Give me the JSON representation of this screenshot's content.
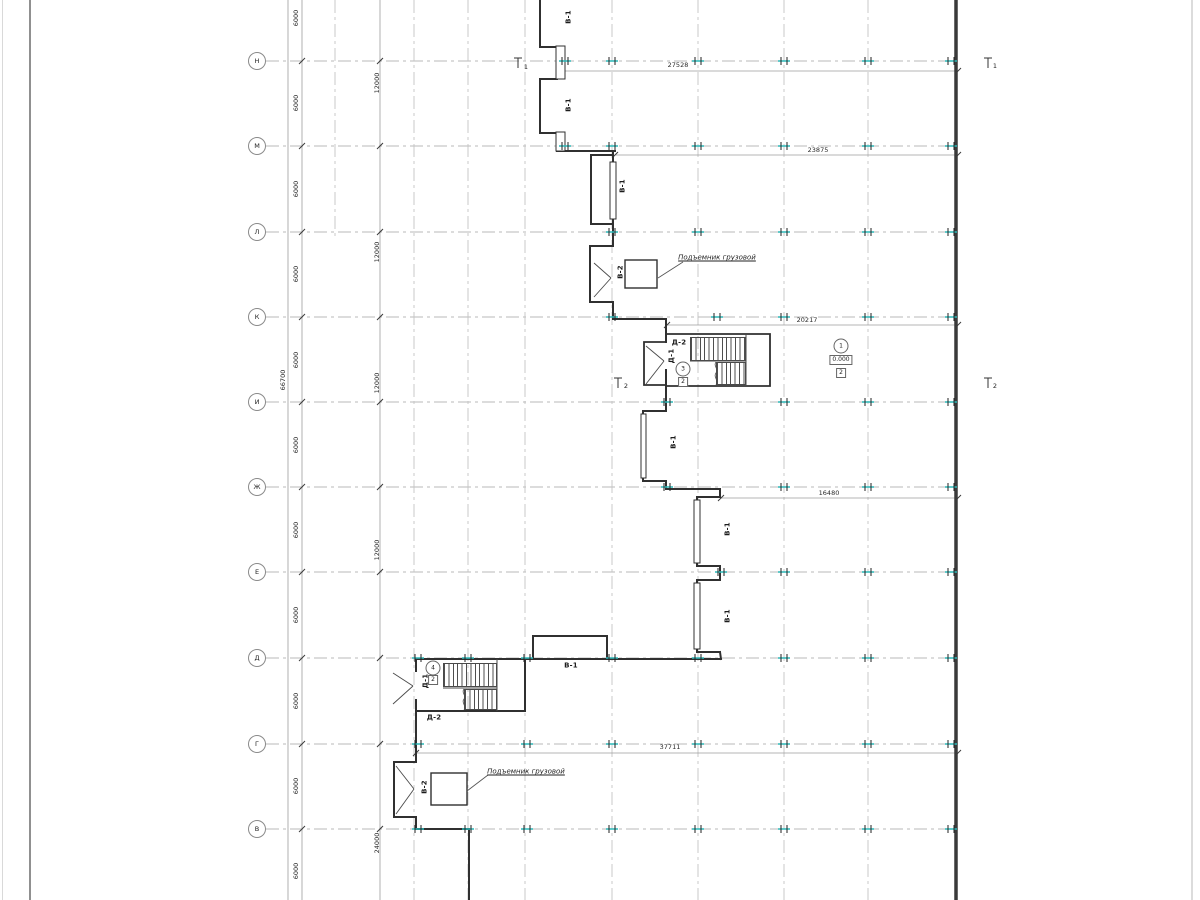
{
  "axes": {
    "rows": [
      "Н",
      "М",
      "Л",
      "К",
      "И",
      "Ж",
      "Е",
      "Д",
      "Г",
      "В"
    ]
  },
  "dims": {
    "total_v": "66700",
    "bay_v": "6000",
    "double_bay_v": "12000",
    "quad_bay_v": "24000",
    "top": "27528",
    "second": "23875",
    "third": "20217",
    "fourth": "16480",
    "bottom": "37711"
  },
  "marks": {
    "window": "В-1",
    "lift_shaft": "В-2",
    "door1": "Д-1",
    "door2": "Д-2"
  },
  "rooms": {
    "room1": "1",
    "room3": "3",
    "room4": "4",
    "floor_mark": "2",
    "elevation": "0.000"
  },
  "sections": {
    "s1": "1",
    "s2": "2"
  },
  "annotations": {
    "freight_lift": "Подъемник грузовой"
  }
}
